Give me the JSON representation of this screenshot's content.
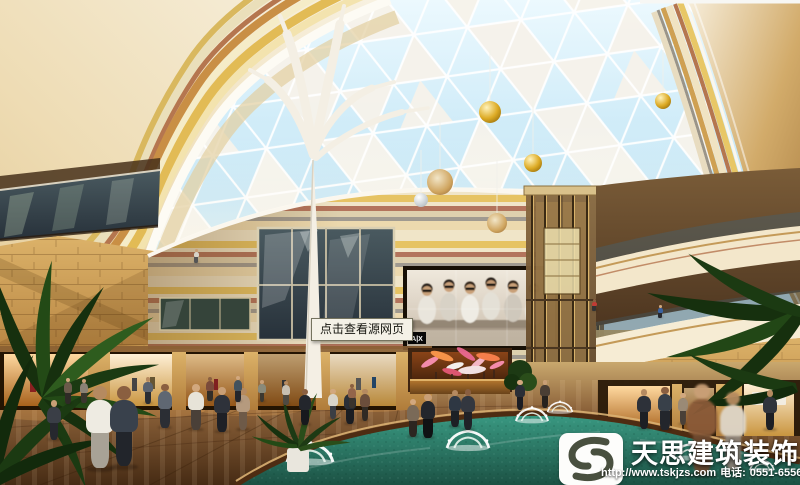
{
  "tooltip": {
    "text": "点击查看源网页"
  },
  "watermark": {
    "company_name": "天思建筑装饰",
    "website_url": "http://www.tskjzs.com",
    "phone_label": "电话:",
    "phone_number": "0551-65568226",
    "logo_icon": "s-swirl-logo"
  },
  "led_screen": {
    "brand_label": "A|X"
  },
  "palette": {
    "sky_blue": "#bfe4f5",
    "dome_panel_white": "#f7f3ea",
    "wall_cream": "#efe2c2",
    "stripe_gold": "#e2bb55",
    "stripe_red": "#b5764f",
    "sandstone": "#c89a52",
    "pool_teal": "#2f8572",
    "floor_brown": "#7a5a38",
    "watermark_text": "#ffffff"
  }
}
